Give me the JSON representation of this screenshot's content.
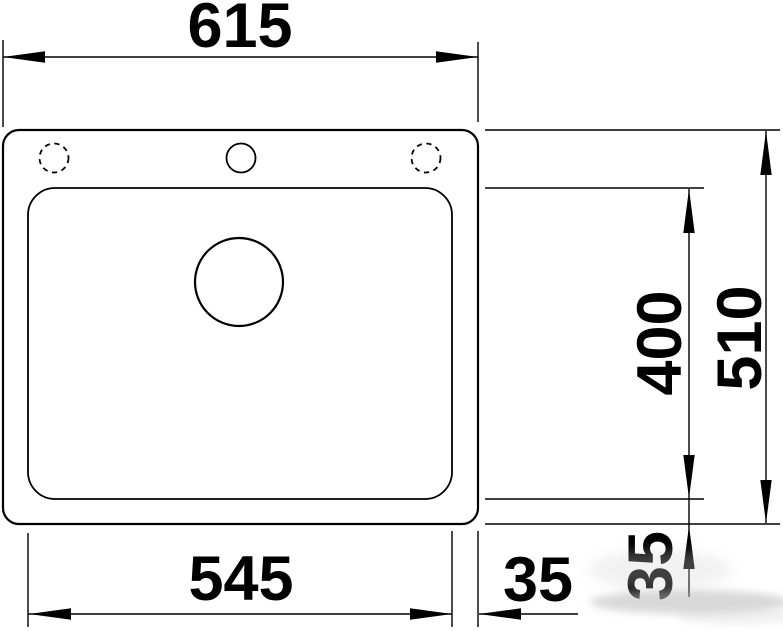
{
  "drawing": {
    "subject": "sink-top-view-dimension-drawing",
    "colors": {
      "line": "#000000",
      "background": "#ffffff",
      "smudge": "#b9b9b9"
    },
    "dimension_labels": {
      "overall_width": "615",
      "overall_depth": "510",
      "bowl_width": "545",
      "bowl_depth": "400",
      "right_edge_offset": "35",
      "bottom_edge_offset": "35"
    },
    "features": {
      "sink_outline": "sink-outer-edge",
      "bowl_outline": "bowl-inner-edge",
      "drain_hole": "drain-hole",
      "tap_hole_center": "tap-hole",
      "tap_hole_left": "optional-tap-hole-dashed",
      "tap_hole_right": "optional-tap-hole-dashed"
    }
  }
}
